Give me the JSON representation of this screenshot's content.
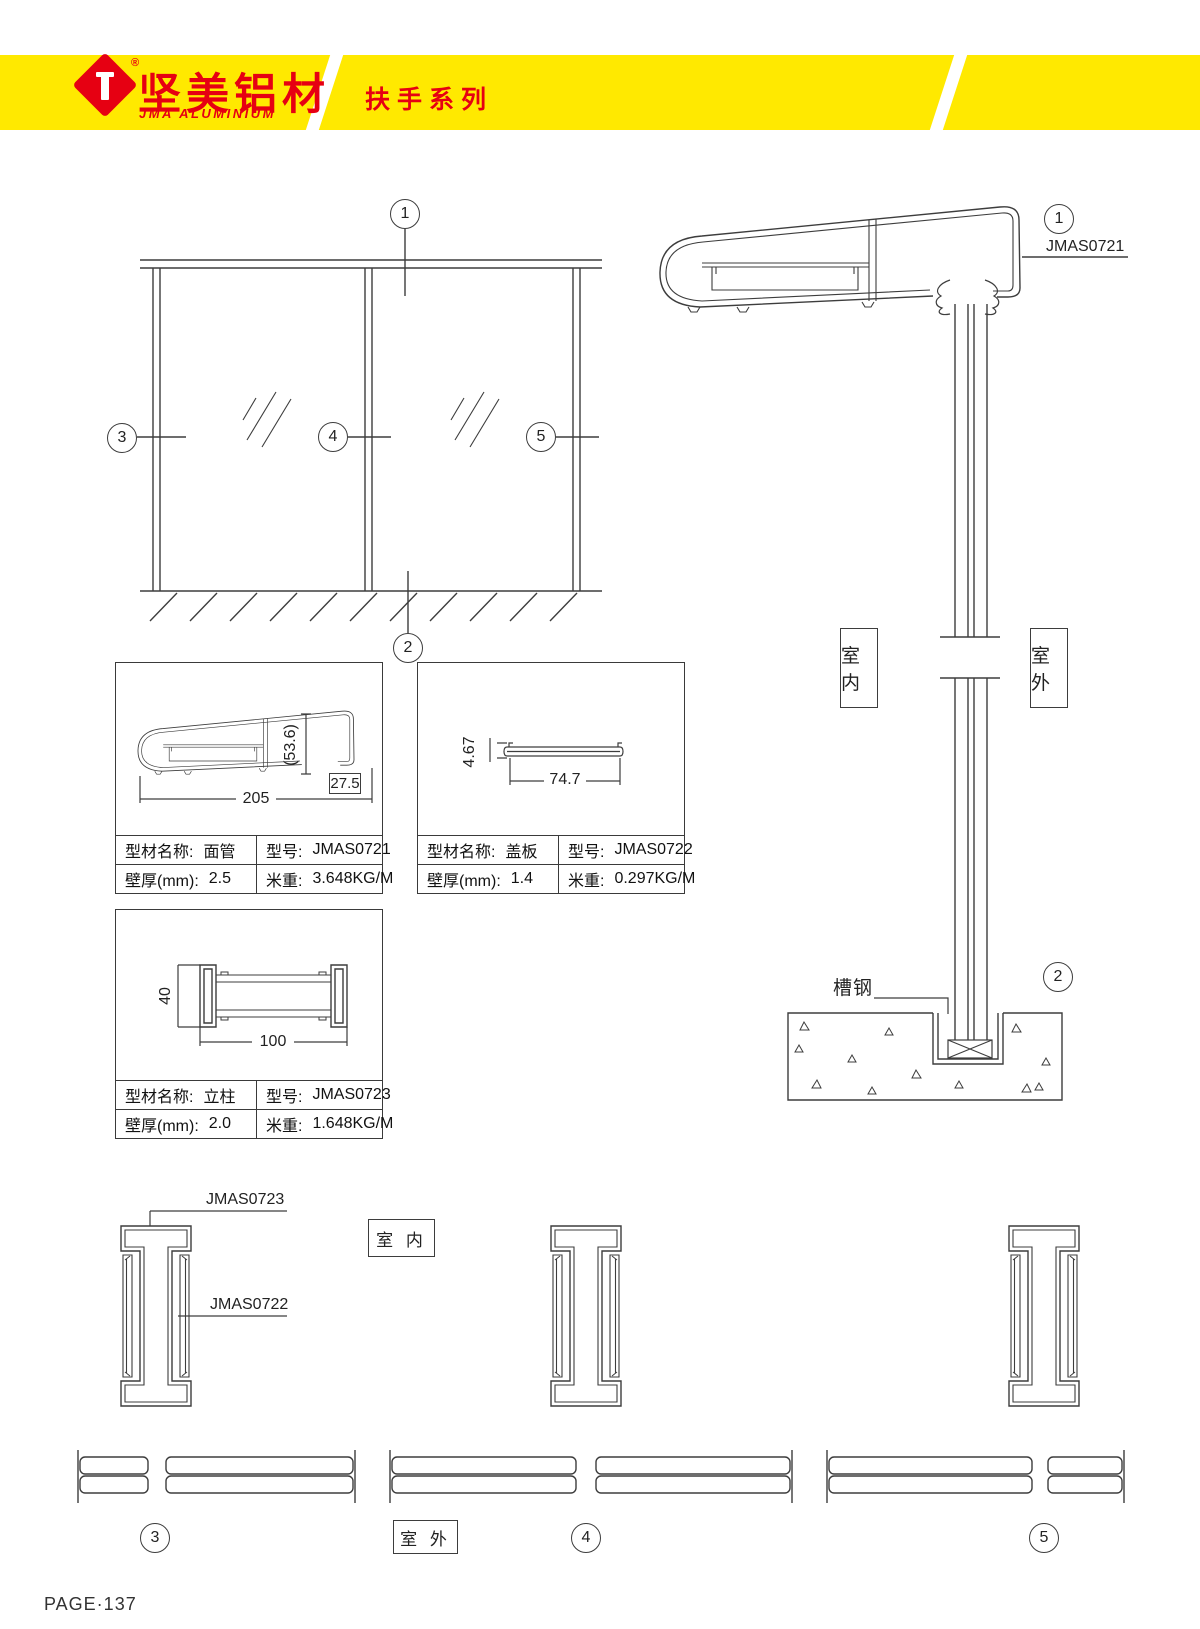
{
  "header": {
    "brand_cn": "坚美铝材",
    "brand_en": "JMA ALUMINIUM",
    "reg_mark": "®",
    "series_title": "扶手系列"
  },
  "colors": {
    "brand_yellow": "#ffe900",
    "brand_red": "#e60012"
  },
  "callouts": {
    "c1": "1",
    "c2": "2",
    "c3": "3",
    "c4": "4",
    "c5": "5"
  },
  "section": {
    "top_profile_label": "JMAS0721",
    "indoor_vertical": "室内",
    "outdoor_vertical": "室外",
    "channel_label": "槽钢"
  },
  "plan": {
    "post_label": "JMAS0723",
    "cover_label": "JMAS0722",
    "indoor": "室 内",
    "outdoor": "室 外"
  },
  "profiles": [
    {
      "name_label": "型材名称:",
      "name": "面管",
      "model_label": "型号:",
      "model": "JMAS0721",
      "thick_label": "壁厚(mm):",
      "thick": "2.5",
      "weight_label": "米重:",
      "weight": "3.648KG/M",
      "dim_height": "(53.6)",
      "dim_notch": "27.5",
      "dim_width": "205"
    },
    {
      "name_label": "型材名称:",
      "name": "盖板",
      "model_label": "型号:",
      "model": "JMAS0722",
      "thick_label": "壁厚(mm):",
      "thick": "1.4",
      "weight_label": "米重:",
      "weight": "0.297KG/M",
      "dim_height": "4.67",
      "dim_width": "74.7"
    },
    {
      "name_label": "型材名称:",
      "name": "立柱",
      "model_label": "型号:",
      "model": "JMAS0723",
      "thick_label": "壁厚(mm):",
      "thick": "2.0",
      "weight_label": "米重:",
      "weight": "1.648KG/M",
      "dim_height": "40",
      "dim_width": "100"
    }
  ],
  "footer": {
    "page_label": "PAGE·137"
  }
}
